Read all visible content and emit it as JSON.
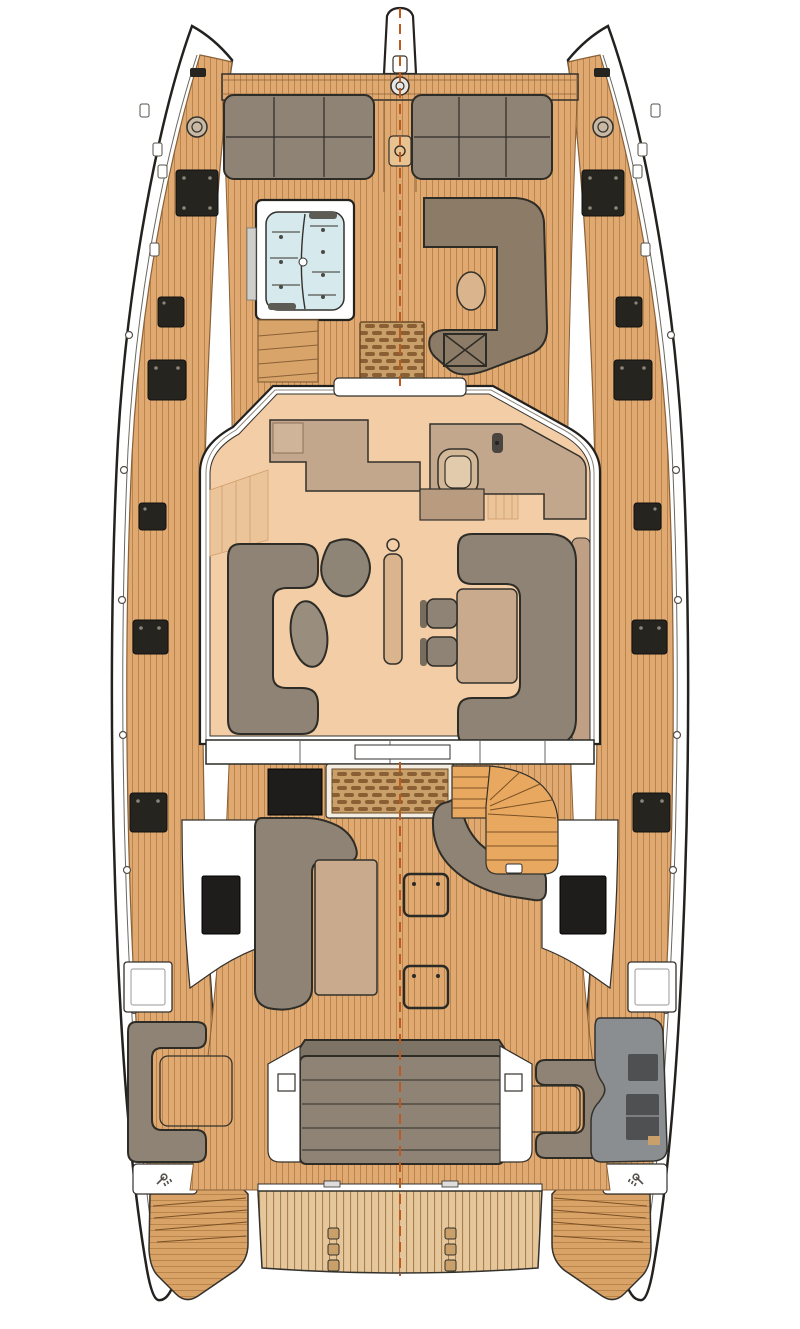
{
  "meta": {
    "description": "Top-down deck floor plan of a sailing catamaran (main deck layout)",
    "orientation": "bow-up",
    "no_visible_text": true
  },
  "palette": {
    "white": "#ffffff",
    "outline": "#2e2c27",
    "teak": "#dfa971",
    "teak_h": "#d9a267",
    "teak_stripe": "#b9854b",
    "teak_trim": "#8a6138",
    "plat": "#e5c79b",
    "plat_stripe": "#a87f4e",
    "grate_bg": "#caa06a",
    "grate_slat": "#8a5f33",
    "cushion": "#8e8374",
    "cushion_back": "#7e7465",
    "brown": "#8c7c67",
    "salon_floor": "#f2cda5",
    "plank": "#ecc49a",
    "counter": "#c3a78c",
    "counter_light": "#cfb499",
    "table": "#c9aa8c",
    "table_light": "#d9b48c",
    "seatback": "#bfa084",
    "fridge": "#b99b80",
    "sink": "#d3b897",
    "sink_inner": "#e2cbac",
    "stairs": "#e9a85f",
    "stairs_line": "#7a5126",
    "jacuzzi": "#d6e9ec",
    "gray_module": "#8b8e90",
    "gray_dark": "#4e5052",
    "dark_window": "#1e1d1b",
    "hatch": "#26241f",
    "centerline": "#bf5a1e",
    "ottoman": "#998d7d",
    "teardrop": "#8f8577",
    "step_tan": "#d8a469",
    "bronze": "#c9b9a4"
  },
  "areas": [
    "bowsprit",
    "anchor-windlass",
    "foredeck-crossbeam",
    "bow-sunpads",
    "jacuzzi",
    "forward-lounge",
    "forward-deck-grate",
    "companionway-steps",
    "port-hull-deck",
    "starboard-hull-deck",
    "deck-hatches",
    "salon",
    "galley-counter",
    "galley-sink",
    "dining-sofa",
    "dining-table",
    "dining-chairs",
    "salon-sofa",
    "coffee-table",
    "ottoman",
    "mast-post",
    "aft-cockpit",
    "cockpit-bench-grate",
    "spiral-staircase",
    "cockpit-sofa",
    "cockpit-table",
    "deck-storage-hatches",
    "side-lounge-port",
    "side-lounge-starboard",
    "wet-bar-module",
    "aft-sunbed",
    "transom-lockers",
    "swim-platform",
    "transom-steps",
    "centerline-dashed"
  ]
}
